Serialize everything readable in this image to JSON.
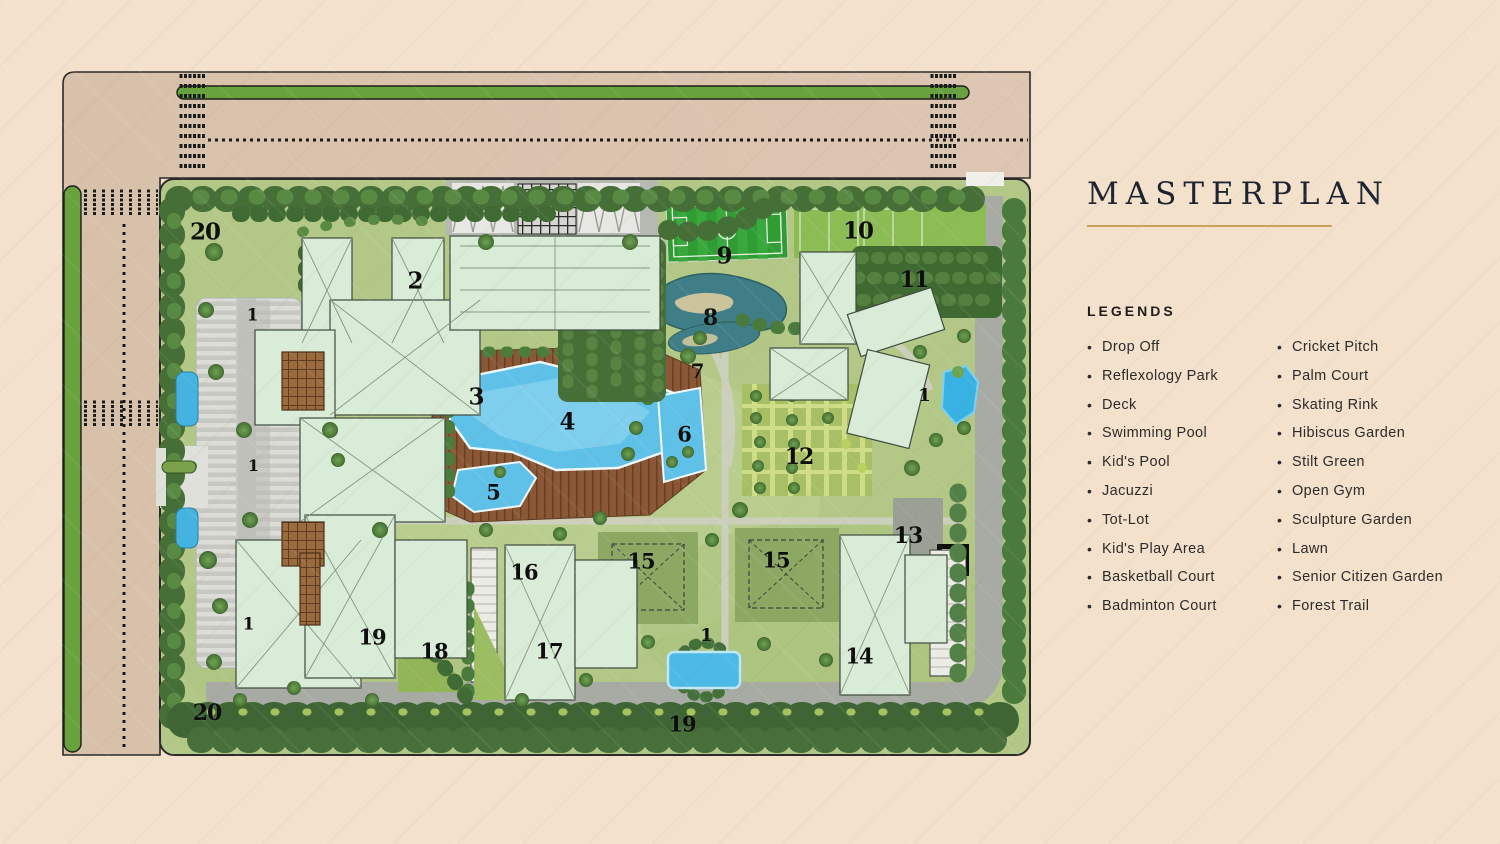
{
  "header": {
    "title": "MASTERPLAN"
  },
  "legends": {
    "heading": "LEGENDS",
    "bullet_glyph": "•",
    "left": [
      "Drop Off",
      "Reflexology Park",
      "Deck",
      "Swimming Pool",
      "Kid's Pool",
      "Jacuzzi",
      "Tot-Lot",
      "Kid's Play Area",
      "Basketball Court",
      "Badminton Court"
    ],
    "right": [
      "Cricket Pitch",
      "Palm Court",
      "Skating Rink",
      "Hibiscus Garden",
      "Stilt Green",
      "Open Gym",
      "Sculpture Garden",
      "Lawn",
      "Senior Citizen Garden",
      "Forest Trail"
    ]
  },
  "map": {
    "markers": [
      {
        "label": "20",
        "x": 205,
        "y": 232,
        "size": 23
      },
      {
        "label": "2",
        "x": 415,
        "y": 281,
        "size": 23
      },
      {
        "label": "1",
        "x": 252,
        "y": 316,
        "size": 17
      },
      {
        "label": "9",
        "x": 724,
        "y": 256,
        "size": 23
      },
      {
        "label": "10",
        "x": 858,
        "y": 231,
        "size": 23
      },
      {
        "label": "8",
        "x": 710,
        "y": 318,
        "size": 22
      },
      {
        "label": "11",
        "x": 914,
        "y": 280,
        "size": 22
      },
      {
        "label": "7",
        "x": 697,
        "y": 371,
        "size": 20
      },
      {
        "label": "3",
        "x": 476,
        "y": 397,
        "size": 23
      },
      {
        "label": "4",
        "x": 567,
        "y": 422,
        "size": 23
      },
      {
        "label": "6",
        "x": 684,
        "y": 434,
        "size": 21
      },
      {
        "label": "1",
        "x": 924,
        "y": 396,
        "size": 18
      },
      {
        "label": "12",
        "x": 799,
        "y": 457,
        "size": 22
      },
      {
        "label": "5",
        "x": 493,
        "y": 492,
        "size": 21
      },
      {
        "label": "1",
        "x": 253,
        "y": 466,
        "size": 16
      },
      {
        "label": "13",
        "x": 908,
        "y": 536,
        "size": 22
      },
      {
        "label": "16",
        "x": 524,
        "y": 572,
        "size": 21
      },
      {
        "label": "15",
        "x": 641,
        "y": 561,
        "size": 21
      },
      {
        "label": "15",
        "x": 776,
        "y": 560,
        "size": 21
      },
      {
        "label": "19",
        "x": 372,
        "y": 637,
        "size": 21
      },
      {
        "label": "18",
        "x": 434,
        "y": 651,
        "size": 21
      },
      {
        "label": "17",
        "x": 549,
        "y": 651,
        "size": 21
      },
      {
        "label": "1",
        "x": 706,
        "y": 636,
        "size": 18
      },
      {
        "label": "14",
        "x": 859,
        "y": 656,
        "size": 21
      },
      {
        "label": "1",
        "x": 248,
        "y": 625,
        "size": 17
      },
      {
        "label": "20",
        "x": 207,
        "y": 713,
        "size": 22
      },
      {
        "label": "19",
        "x": 682,
        "y": 724,
        "size": 21
      }
    ],
    "colors": {
      "background_tan": "#f3e1cc",
      "road_tan": "#d9c2ab",
      "lawn_green": "#b3c887",
      "hedge_green": "#456f37",
      "pool_blue": "#5fc0e8",
      "deck_brown": "#8a5837",
      "pitch_green": "#2f9d34",
      "building_mint": "#d9ecd8",
      "title_underline_gold": "#c9a35c"
    }
  }
}
